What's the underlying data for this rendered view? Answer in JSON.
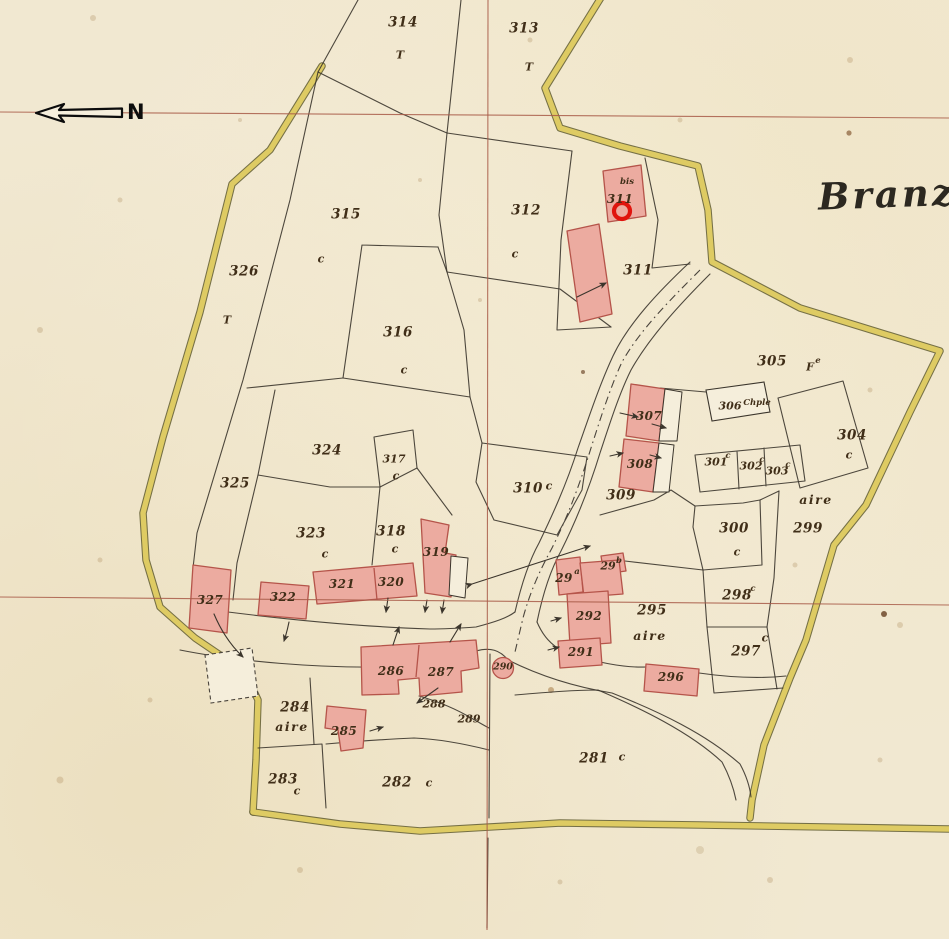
{
  "title": {
    "text": "Branza"
  },
  "compass": {
    "label": "N"
  },
  "marker": {
    "parcel": "311",
    "color": "#e0140e"
  },
  "colors": {
    "paper": "#f1e8d1",
    "road_yellow": "#decb63",
    "building_pink": "#ecaba0",
    "building_border": "#b5544a",
    "survey_grid_red": "#a85a48",
    "boundary_black": "#3b352c"
  },
  "labels": [
    {
      "text": "314",
      "x": 403,
      "y": 23,
      "cls": "num"
    },
    {
      "text": "T",
      "x": 400,
      "y": 55,
      "cls": "sym"
    },
    {
      "text": "313",
      "x": 524,
      "y": 29,
      "cls": "num"
    },
    {
      "text": "T",
      "x": 529,
      "y": 67,
      "cls": "sym"
    },
    {
      "text": "315",
      "x": 346,
      "y": 215,
      "cls": "num"
    },
    {
      "text": "c",
      "x": 321,
      "y": 259,
      "cls": "sym"
    },
    {
      "text": "312",
      "x": 526,
      "y": 211,
      "cls": "num"
    },
    {
      "text": "c",
      "x": 515,
      "y": 254,
      "cls": "sym"
    },
    {
      "text": "326",
      "x": 244,
      "y": 272,
      "cls": "num"
    },
    {
      "text": "T",
      "x": 227,
      "y": 320,
      "cls": "sym"
    },
    {
      "text": "316",
      "x": 398,
      "y": 333,
      "cls": "num"
    },
    {
      "text": "c",
      "x": 404,
      "y": 370,
      "cls": "sym"
    },
    {
      "text": "bis",
      "x": 627,
      "y": 182,
      "cls": "tiny"
    },
    {
      "text": "311",
      "x": 620,
      "y": 199,
      "cls": "onb"
    },
    {
      "text": "311",
      "x": 638,
      "y": 271,
      "cls": "num"
    },
    {
      "text": "305",
      "x": 772,
      "y": 362,
      "cls": "num"
    },
    {
      "text": "F",
      "x": 810,
      "y": 367,
      "cls": "small"
    },
    {
      "text": "e",
      "x": 818,
      "y": 361,
      "cls": "tiny"
    },
    {
      "text": "306",
      "x": 730,
      "y": 406,
      "cls": "small"
    },
    {
      "text": "Chple",
      "x": 757,
      "y": 403,
      "cls": "tiny"
    },
    {
      "text": "304",
      "x": 852,
      "y": 436,
      "cls": "num"
    },
    {
      "text": "c",
      "x": 849,
      "y": 455,
      "cls": "sym"
    },
    {
      "text": "307",
      "x": 649,
      "y": 416,
      "cls": "onb"
    },
    {
      "text": "308",
      "x": 640,
      "y": 464,
      "cls": "onb"
    },
    {
      "text": "309",
      "x": 621,
      "y": 496,
      "cls": "num"
    },
    {
      "text": "301",
      "x": 716,
      "y": 462,
      "cls": "small"
    },
    {
      "text": "c",
      "x": 728,
      "y": 456,
      "cls": "tiny"
    },
    {
      "text": "302",
      "x": 751,
      "y": 466,
      "cls": "small"
    },
    {
      "text": "c",
      "x": 762,
      "y": 460,
      "cls": "tiny"
    },
    {
      "text": "303",
      "x": 777,
      "y": 471,
      "cls": "small"
    },
    {
      "text": "c",
      "x": 788,
      "y": 465,
      "cls": "tiny"
    },
    {
      "text": "aire",
      "x": 816,
      "y": 500,
      "cls": "aire"
    },
    {
      "text": "299",
      "x": 808,
      "y": 529,
      "cls": "num"
    },
    {
      "text": "300",
      "x": 734,
      "y": 529,
      "cls": "num"
    },
    {
      "text": "c",
      "x": 737,
      "y": 552,
      "cls": "sym"
    },
    {
      "text": "310",
      "x": 528,
      "y": 489,
      "cls": "num"
    },
    {
      "text": "c",
      "x": 549,
      "y": 486,
      "cls": "sym"
    },
    {
      "text": "324",
      "x": 327,
      "y": 451,
      "cls": "num"
    },
    {
      "text": "317",
      "x": 394,
      "y": 459,
      "cls": "small"
    },
    {
      "text": "c",
      "x": 396,
      "y": 476,
      "cls": "sym"
    },
    {
      "text": "325",
      "x": 235,
      "y": 484,
      "cls": "num"
    },
    {
      "text": "323",
      "x": 311,
      "y": 534,
      "cls": "num"
    },
    {
      "text": "c",
      "x": 325,
      "y": 554,
      "cls": "sym"
    },
    {
      "text": "318",
      "x": 391,
      "y": 532,
      "cls": "num"
    },
    {
      "text": "c",
      "x": 395,
      "y": 549,
      "cls": "sym"
    },
    {
      "text": "319",
      "x": 436,
      "y": 552,
      "cls": "onb"
    },
    {
      "text": "327",
      "x": 210,
      "y": 600,
      "cls": "onb"
    },
    {
      "text": "322",
      "x": 283,
      "y": 597,
      "cls": "onb"
    },
    {
      "text": "321",
      "x": 342,
      "y": 584,
      "cls": "onb"
    },
    {
      "text": "320",
      "x": 391,
      "y": 582,
      "cls": "onb"
    },
    {
      "text": "298",
      "x": 737,
      "y": 596,
      "cls": "num"
    },
    {
      "text": "c",
      "x": 753,
      "y": 589,
      "cls": "tiny"
    },
    {
      "text": "295",
      "x": 652,
      "y": 611,
      "cls": "num"
    },
    {
      "text": "aire",
      "x": 650,
      "y": 636,
      "cls": "aire"
    },
    {
      "text": "297",
      "x": 746,
      "y": 652,
      "cls": "num"
    },
    {
      "text": "c",
      "x": 765,
      "y": 638,
      "cls": "sym"
    },
    {
      "text": "29",
      "x": 564,
      "y": 578,
      "cls": "onb"
    },
    {
      "text": "a",
      "x": 577,
      "y": 572,
      "cls": "tiny"
    },
    {
      "text": "29",
      "x": 608,
      "y": 566,
      "cls": "small"
    },
    {
      "text": "b",
      "x": 619,
      "y": 561,
      "cls": "tiny"
    },
    {
      "text": "292",
      "x": 589,
      "y": 616,
      "cls": "onb"
    },
    {
      "text": "291",
      "x": 581,
      "y": 652,
      "cls": "onb"
    },
    {
      "text": "296",
      "x": 671,
      "y": 677,
      "cls": "onb"
    },
    {
      "text": "290",
      "x": 503,
      "y": 667,
      "cls": "xs"
    },
    {
      "text": "286",
      "x": 391,
      "y": 671,
      "cls": "onb"
    },
    {
      "text": "287",
      "x": 441,
      "y": 672,
      "cls": "onb"
    },
    {
      "text": "288",
      "x": 434,
      "y": 704,
      "cls": "small"
    },
    {
      "text": "289",
      "x": 469,
      "y": 719,
      "cls": "small"
    },
    {
      "text": "284",
      "x": 295,
      "y": 708,
      "cls": "num"
    },
    {
      "text": "aire",
      "x": 292,
      "y": 727,
      "cls": "aire"
    },
    {
      "text": "285",
      "x": 344,
      "y": 731,
      "cls": "onb"
    },
    {
      "text": "283",
      "x": 283,
      "y": 780,
      "cls": "num"
    },
    {
      "text": "c",
      "x": 297,
      "y": 791,
      "cls": "sym"
    },
    {
      "text": "282",
      "x": 397,
      "y": 783,
      "cls": "num"
    },
    {
      "text": "c",
      "x": 429,
      "y": 783,
      "cls": "sym"
    },
    {
      "text": "281",
      "x": 594,
      "y": 759,
      "cls": "num"
    },
    {
      "text": "c",
      "x": 622,
      "y": 757,
      "cls": "sym"
    }
  ]
}
